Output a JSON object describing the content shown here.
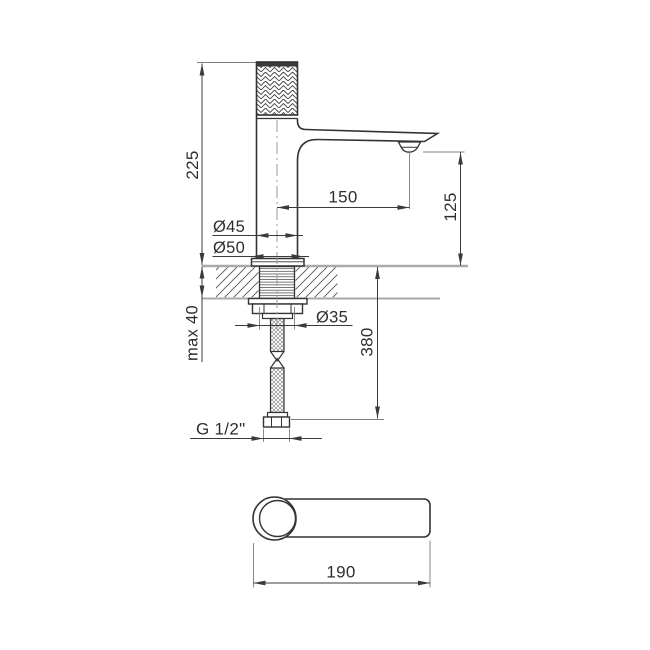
{
  "drawing": {
    "type": "technical-dimension-drawing",
    "subject": "single-lever basin faucet, front section view and top view",
    "dimensions": {
      "total_height": "225",
      "spout_reach": "150",
      "outlet_height": "125",
      "body_diameter": "Ø45",
      "base_diameter": "Ø50",
      "max_deck_thickness": "max 40",
      "shank_diameter": "Ø35",
      "hose_length": "380",
      "connection_thread": "G 1/2\"",
      "handle_length": "190"
    },
    "colors": {
      "outline": "#333333",
      "dimension_line": "#3a3a3a",
      "extension_line": "#7d7d7d",
      "counter_line": "#aaaaaa",
      "centerline": "#999999",
      "text": "#2e2e2e",
      "background": "#ffffff"
    }
  }
}
